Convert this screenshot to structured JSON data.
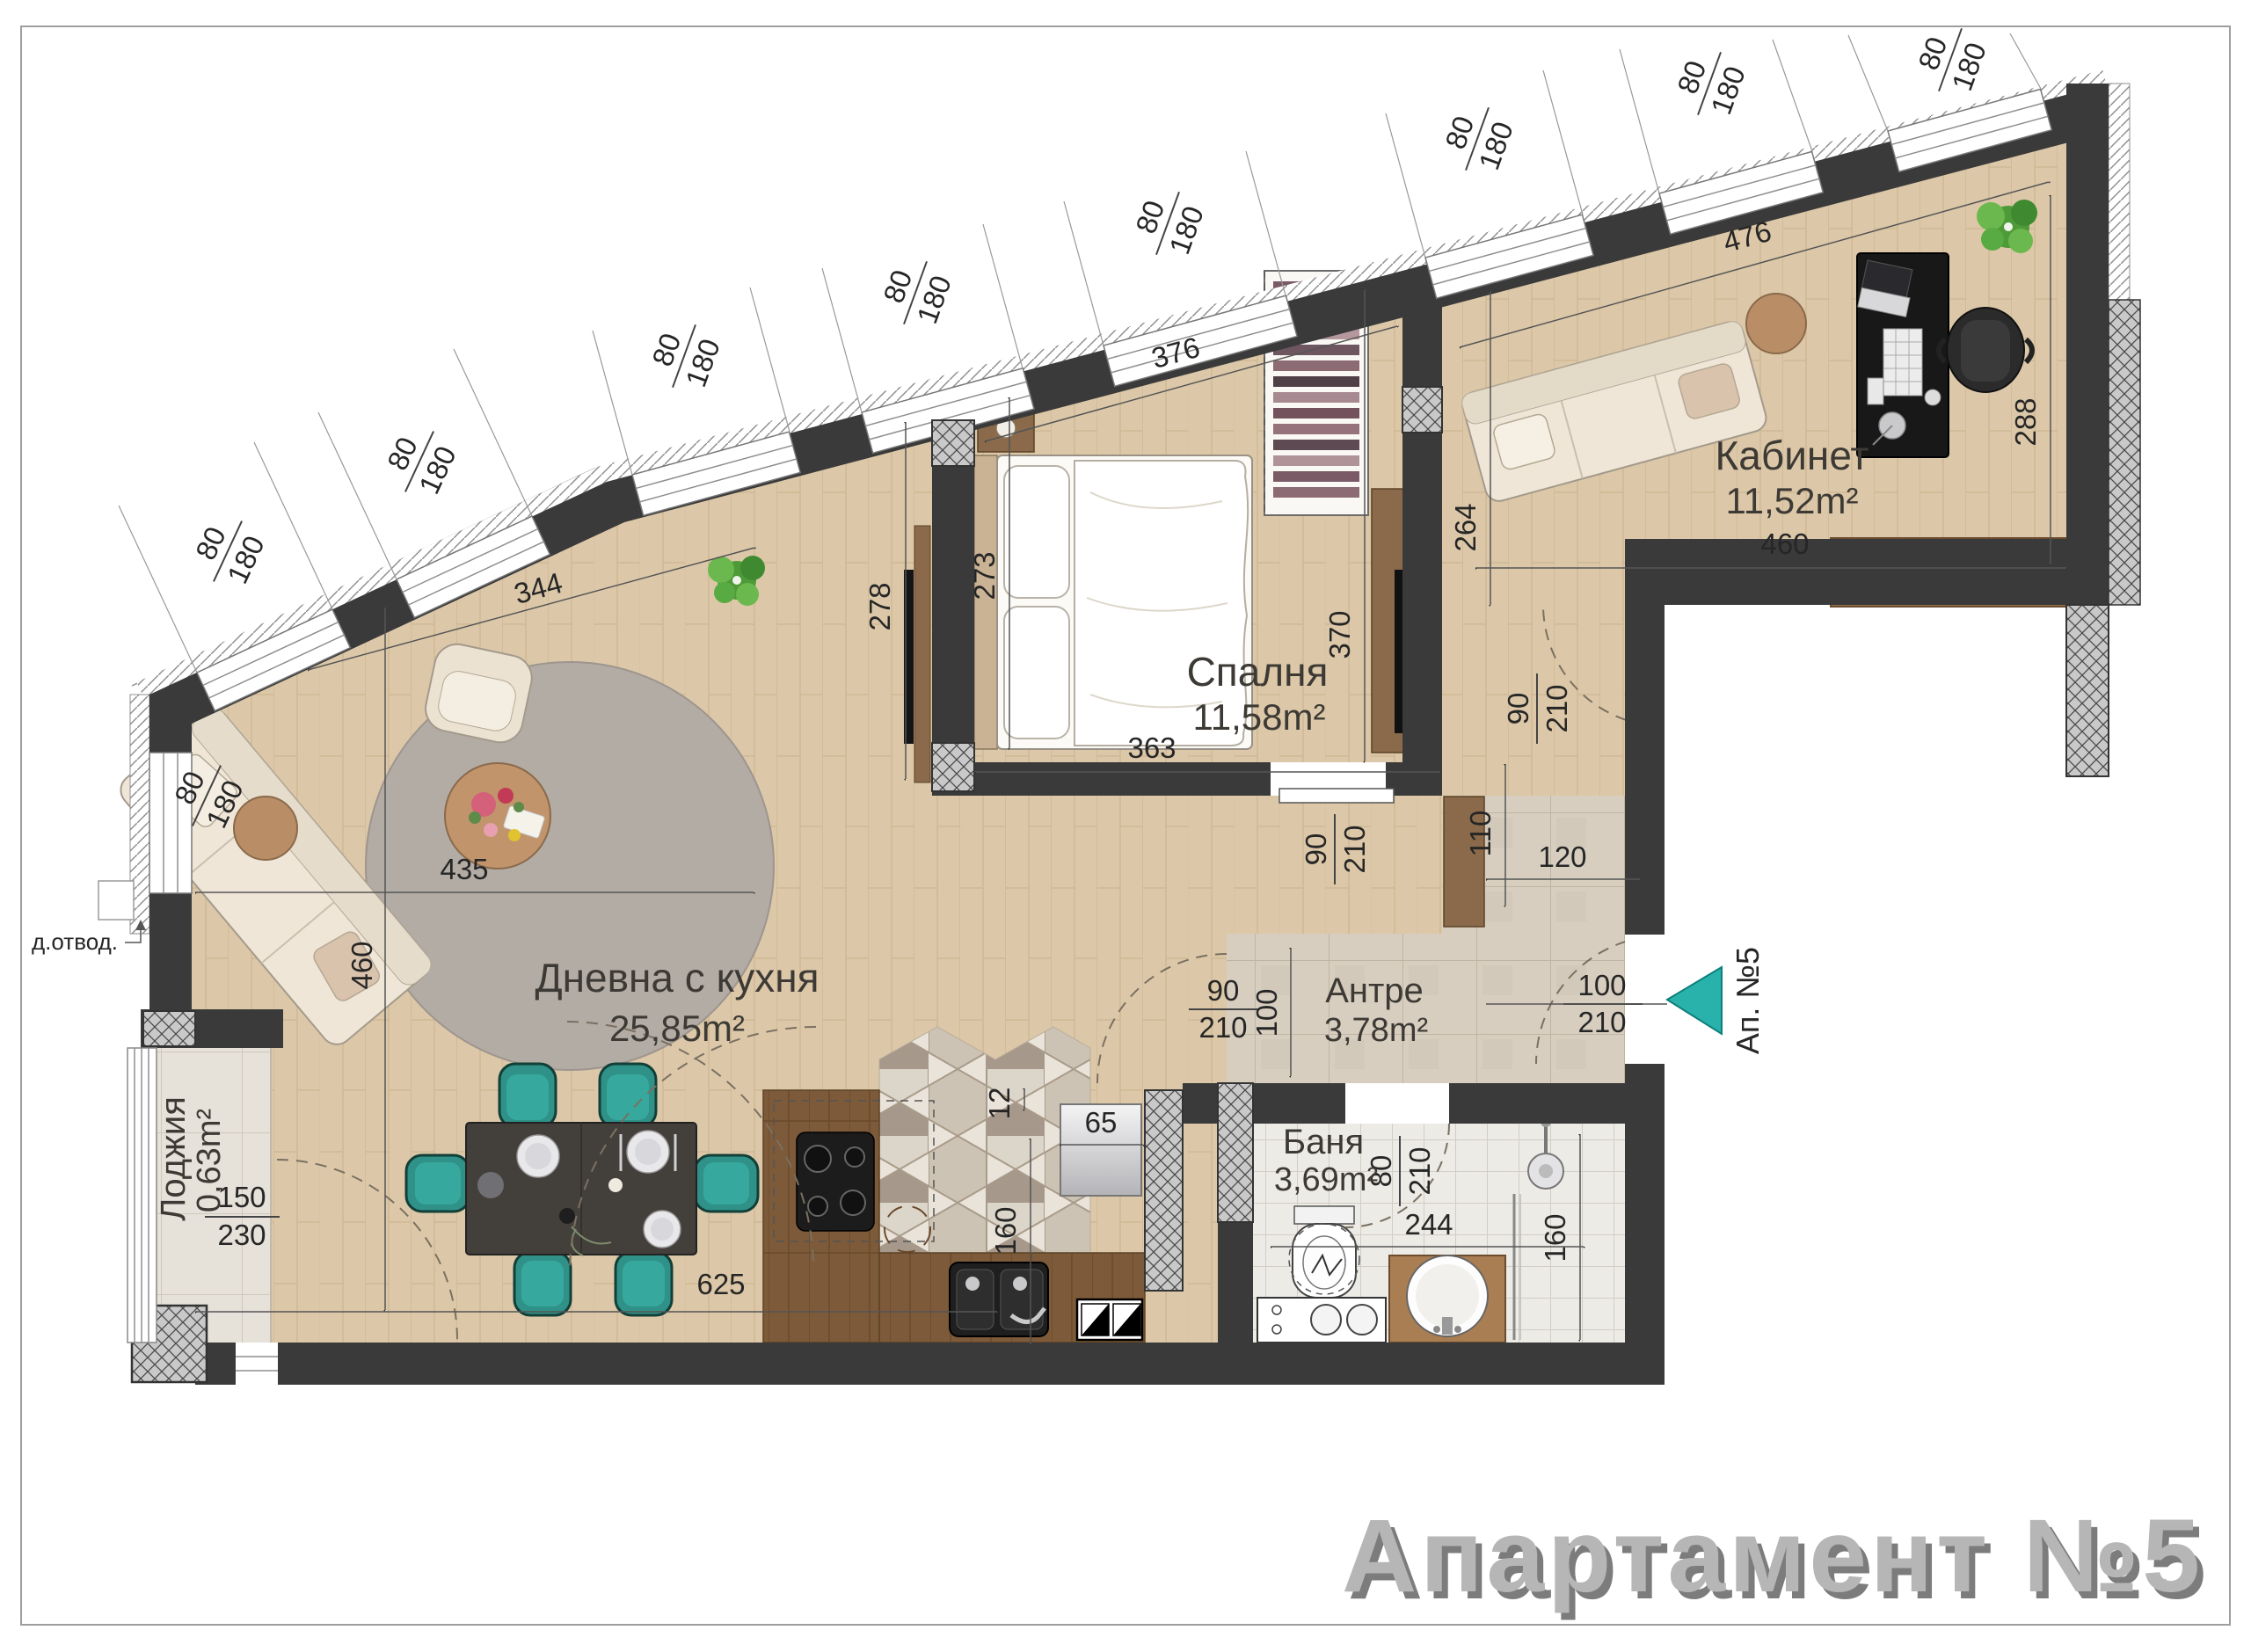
{
  "title": "Апартамент №5",
  "entrance": {
    "label": "Ап. №5"
  },
  "drain": {
    "label": "д.отвод."
  },
  "rooms": {
    "living": {
      "name": "Дневна с кухня",
      "area": "25,85m²"
    },
    "bedroom": {
      "name": "Спалня",
      "area": "11,58m²"
    },
    "office": {
      "name": "Кабинет",
      "area": "11,52m²"
    },
    "hall": {
      "name": "Антре",
      "area": "3,78m²"
    },
    "bath": {
      "name": "Баня",
      "area": "3,69m²"
    },
    "loggia": {
      "name": "Лоджия",
      "area": "0,63m²"
    }
  },
  "window": {
    "w": "80",
    "h": "180"
  },
  "door": {
    "w": "90",
    "h": "210"
  },
  "bath_door": {
    "w": "80",
    "h": "210"
  },
  "entry_door": {
    "w": "100",
    "h": "210"
  },
  "loggia_door": {
    "w": "150",
    "h": "230"
  },
  "dims": {
    "living_top": "344",
    "living_width": "435",
    "living_depth": "460",
    "living_bottom": "625",
    "living_tvwall": "278",
    "bedroom_width": "363",
    "bedroom_top": "376",
    "bedroom_depth": "370",
    "bedroom_side": "273",
    "office_bottom": "460",
    "office_top": "476",
    "office_side": "288",
    "corridor": "264",
    "hall_width": "120",
    "hall_niche": "110",
    "hall_pass": "100",
    "bath_width": "244",
    "bath_side": "160",
    "kitchen_top": "65",
    "kitchen_gap": "12",
    "kitchen_side": "160"
  }
}
